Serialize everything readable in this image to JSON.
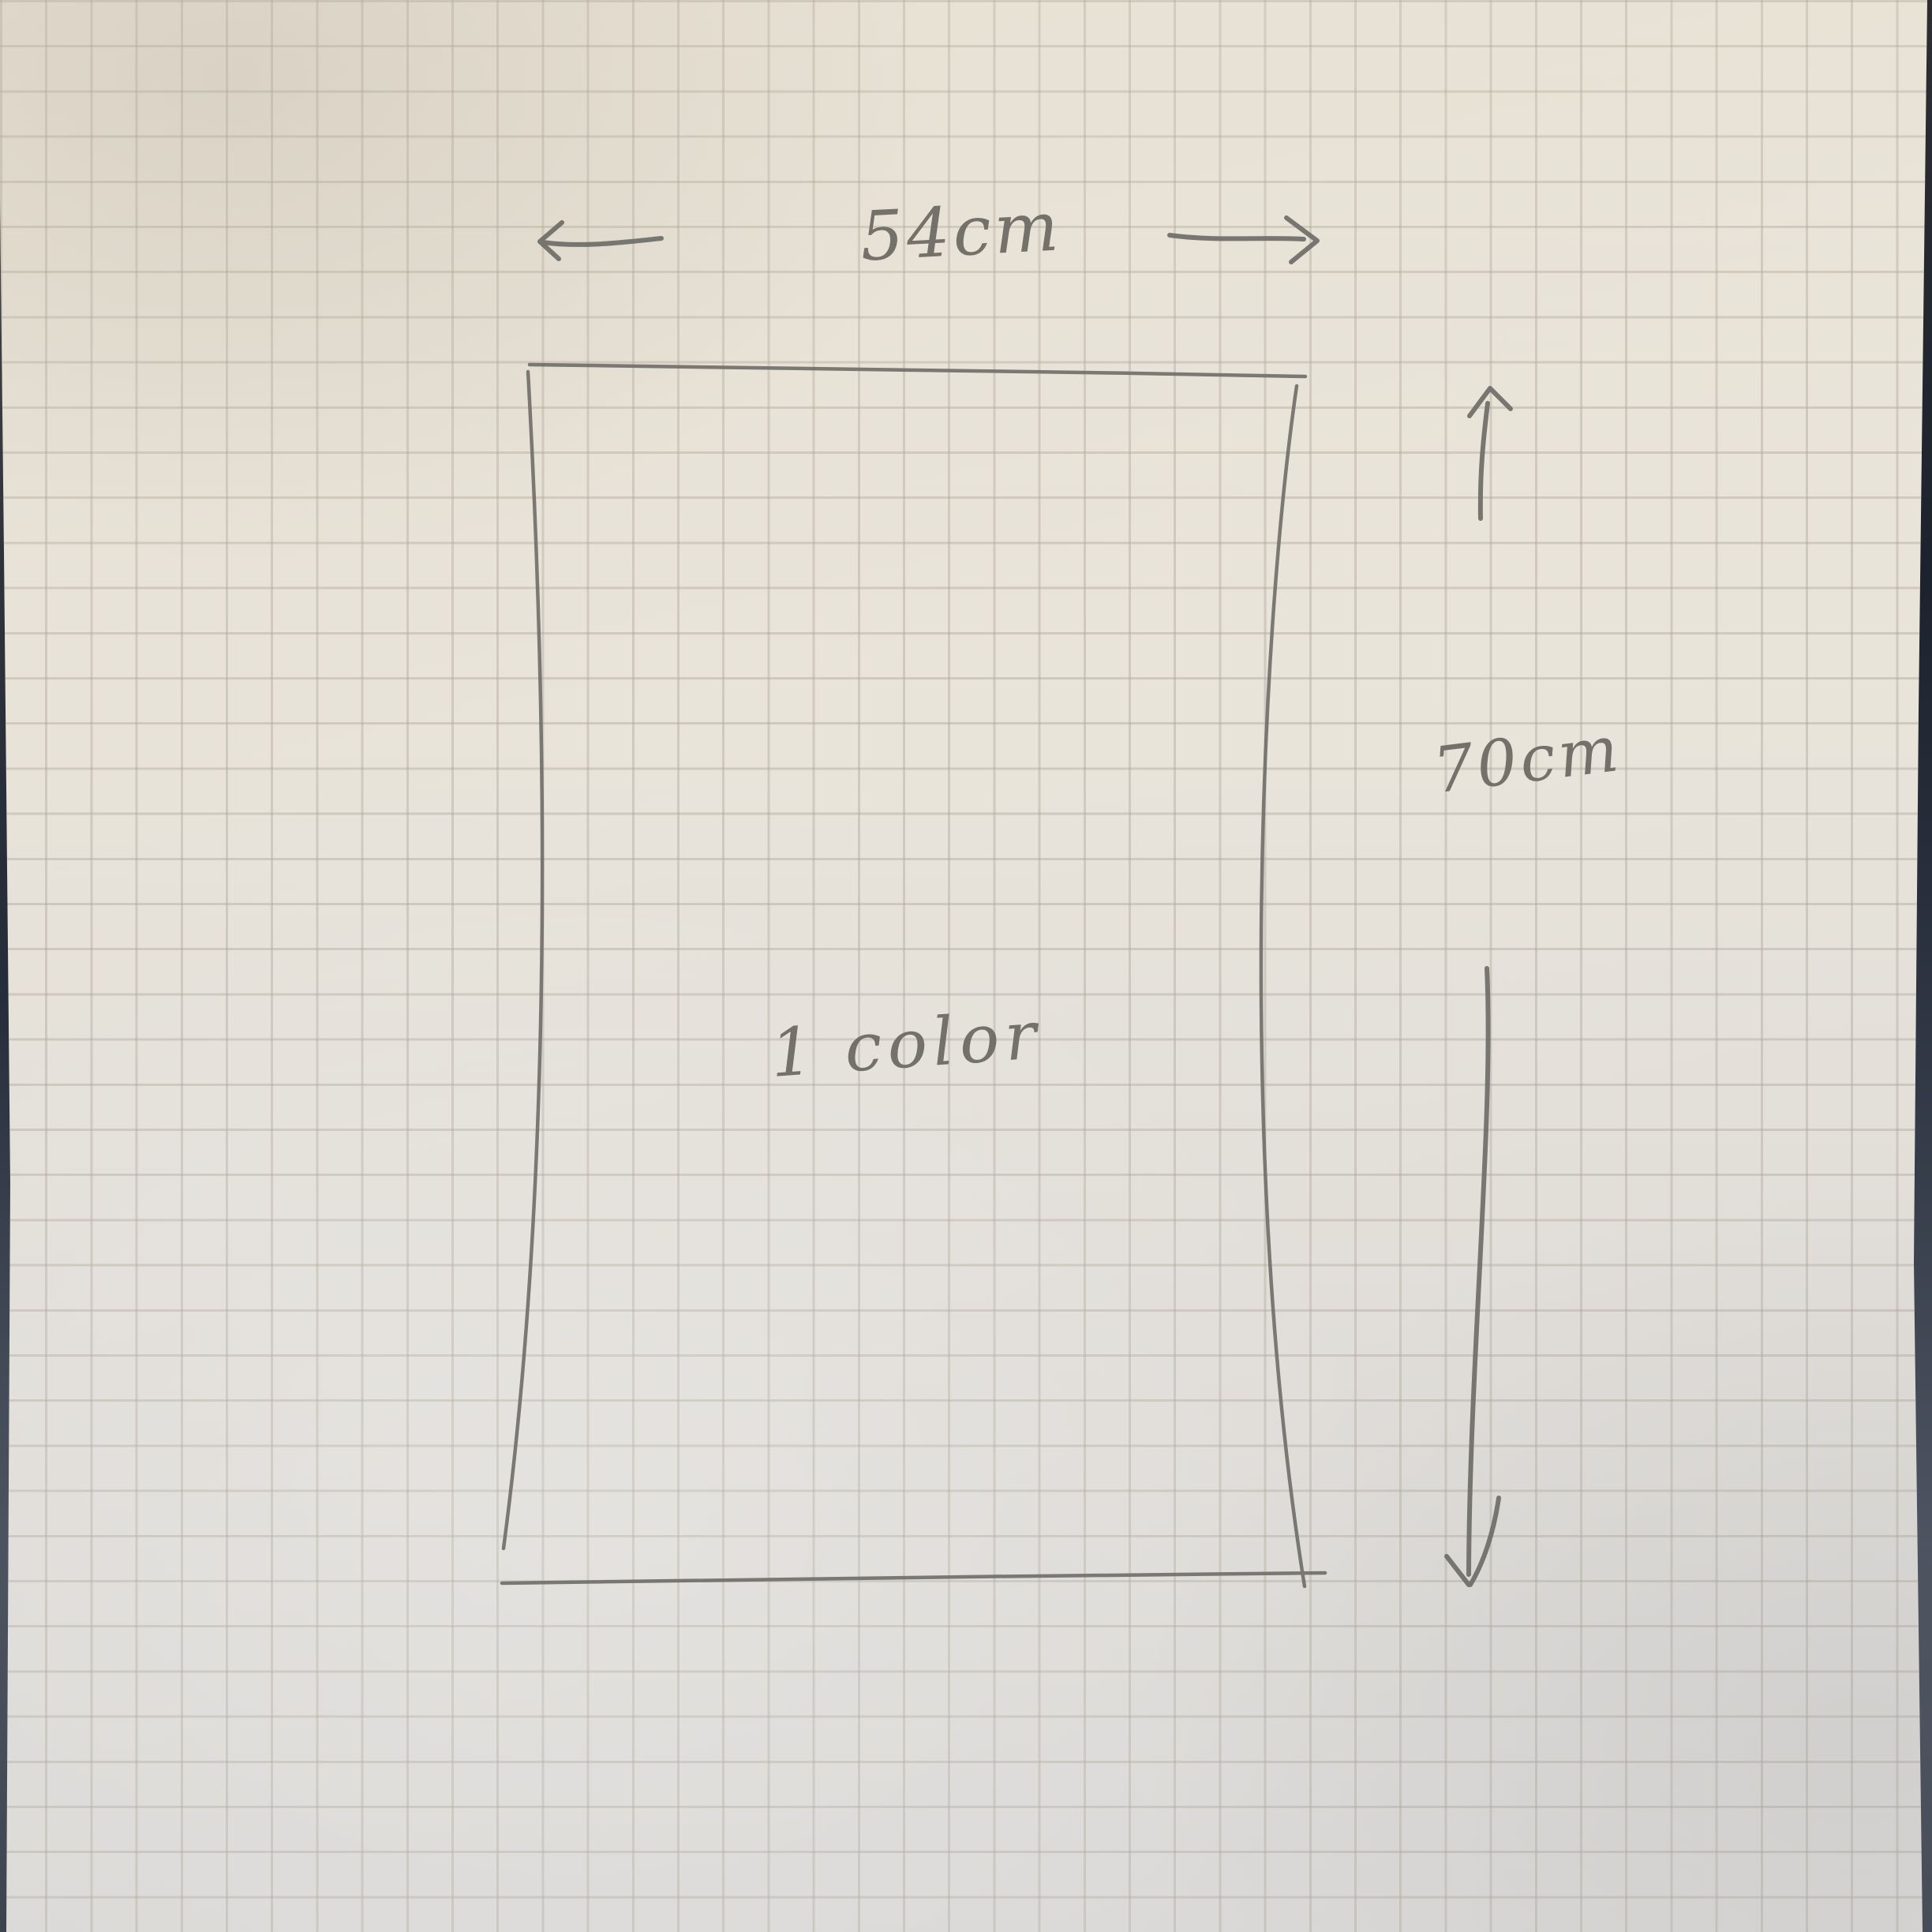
{
  "scene": {
    "background_color": "#222936",
    "paper_color": "#e8e4da",
    "grid_color": "#aca599",
    "pencil_color": "#6f6d68"
  },
  "sketch": {
    "shape": "rectangle",
    "width_label": "54cm",
    "height_label": "70cm",
    "annotation": "1 color",
    "icons": {
      "width_left": "arrow-left",
      "width_right": "arrow-right",
      "height_up": "arrow-up",
      "height_down": "arrow-down"
    }
  }
}
